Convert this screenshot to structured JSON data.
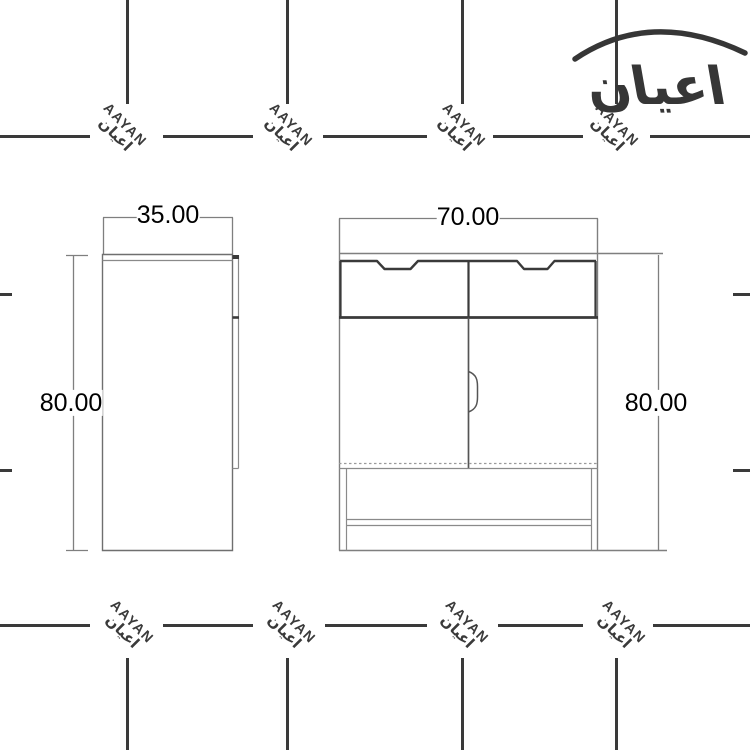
{
  "page": {
    "background_color": "#ffffff"
  },
  "logo": {
    "text": "اعيان"
  },
  "watermark": {
    "latin": "AAYAN",
    "arabic": "اعيان",
    "color": "#3a3a3a"
  },
  "dimensions": {
    "side_width_label": "35.00",
    "front_width_label": "70.00",
    "side_height_label": "80.00",
    "front_height_label": "80.00"
  },
  "colors": {
    "ink": "#3a3a3a",
    "line_thin": "#8a8a8a",
    "line_thick": "#3a3a3a",
    "label_text": "#000000"
  }
}
